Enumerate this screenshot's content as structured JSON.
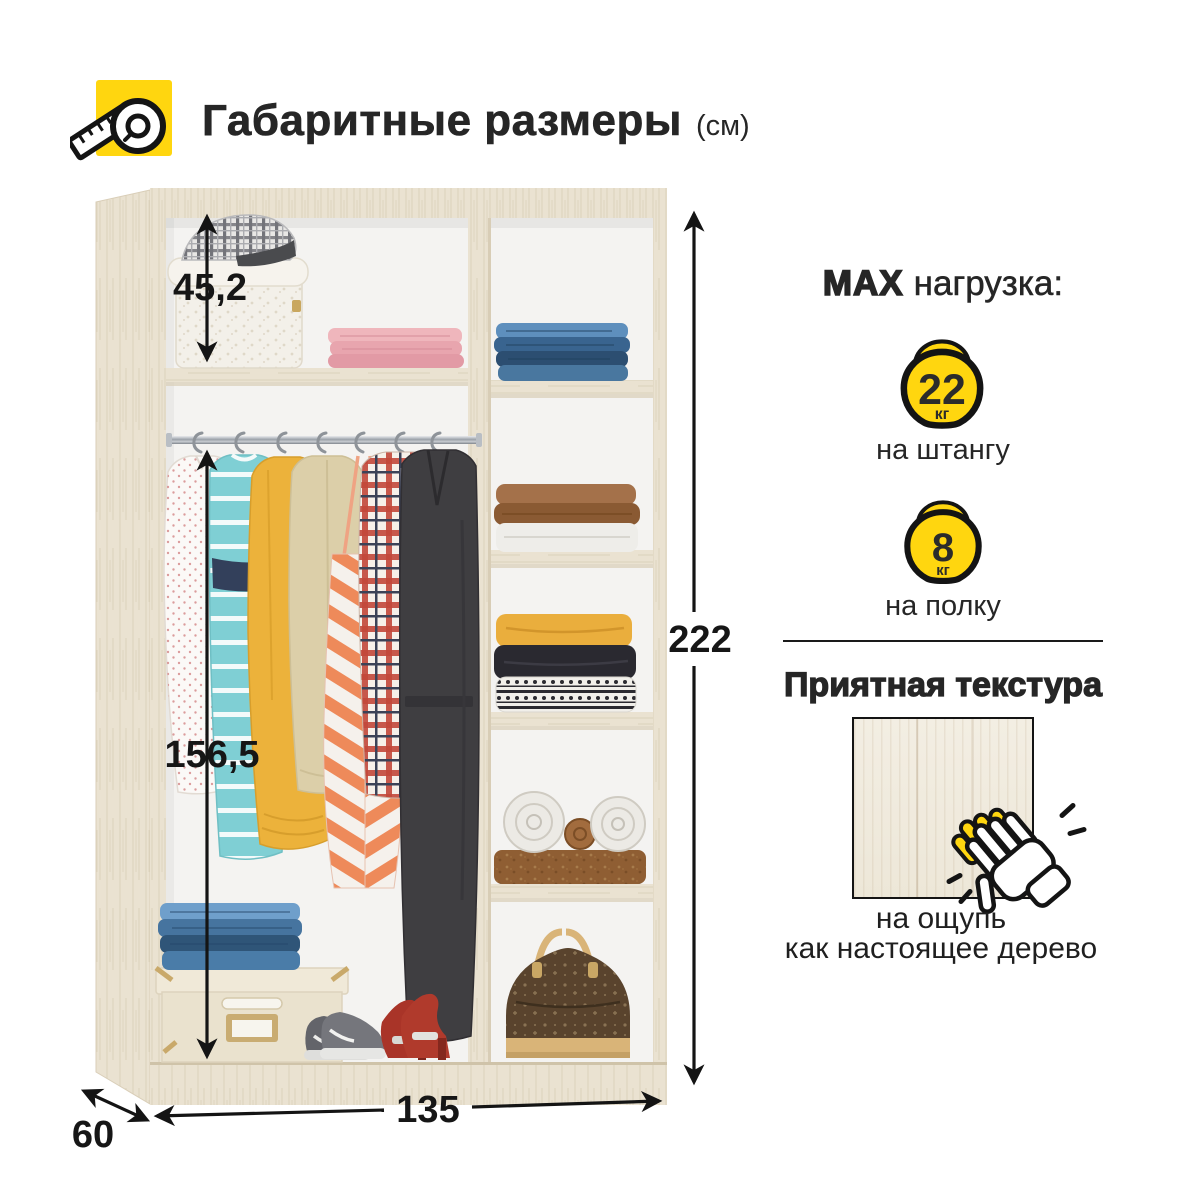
{
  "header": {
    "title": "Габаритные размеры",
    "unit": "(см)"
  },
  "wardrobe": {
    "dimensions": {
      "top_section_height": "45,2",
      "hanging_section_height": "156,5",
      "total_height": "222",
      "width": "135",
      "depth": "60"
    }
  },
  "max_load": {
    "title_strong": "MAX",
    "title_rest": "нагрузка:",
    "items": [
      {
        "weight": "22",
        "unit": "кг",
        "label": "на штангу"
      },
      {
        "weight": "8",
        "unit": "кг",
        "label": "на полку"
      }
    ]
  },
  "texture": {
    "heading": "Приятная текстура",
    "caption_line1": "на ощупь",
    "caption_line2": "как настоящее дерево"
  },
  "icons": [
    "measuring-tape-icon",
    "kettlebell-icon",
    "clapping-hand-icon"
  ],
  "colors": {
    "accent": "#FFD60F",
    "ink": "#1A1A1A",
    "wood": "#EAE2D1"
  }
}
